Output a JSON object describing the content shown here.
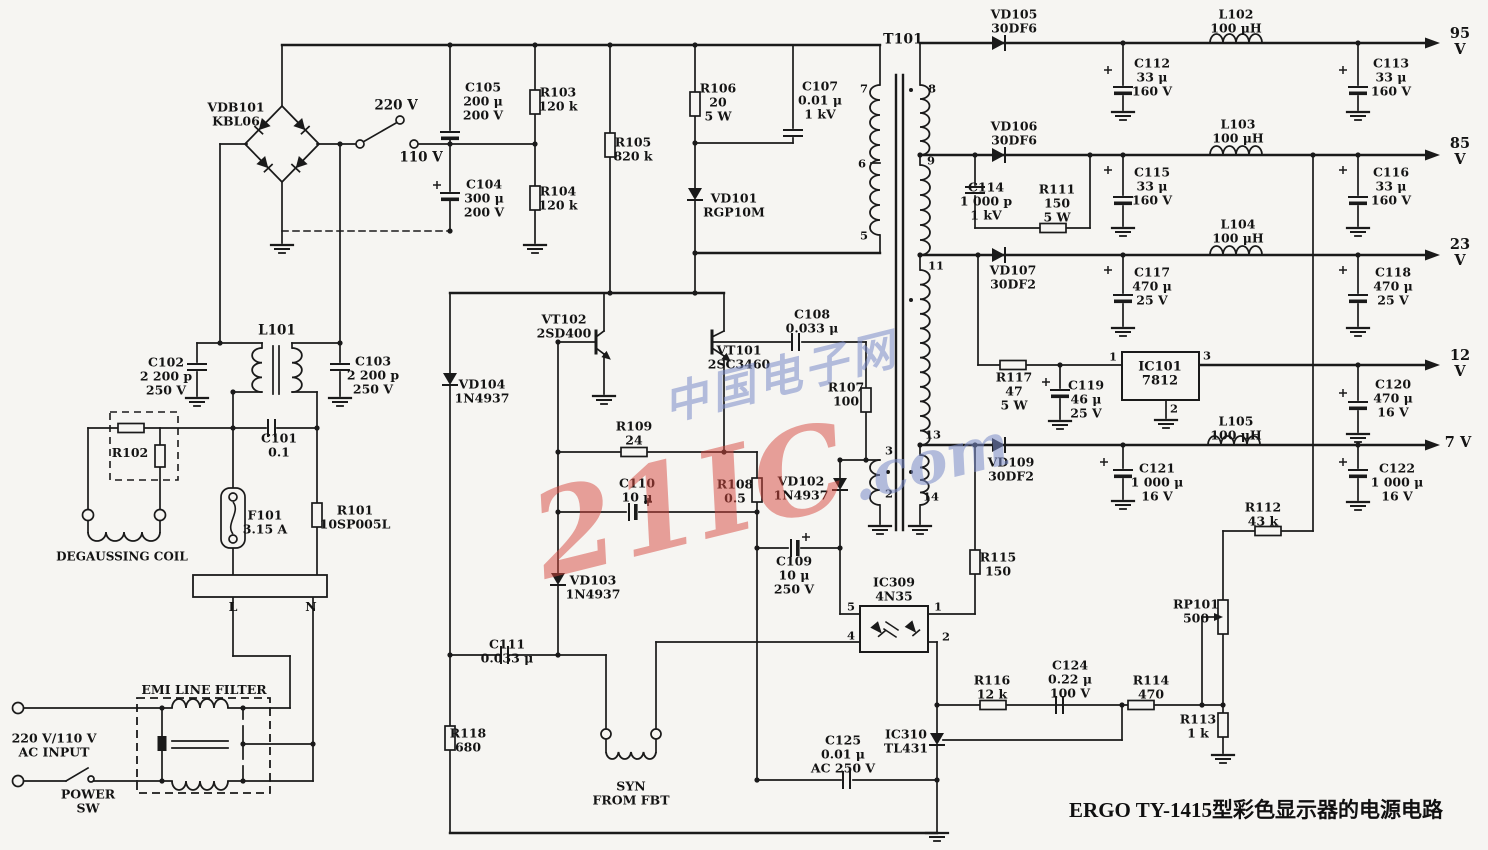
{
  "title": "ERGO TY-1415型彩色显示器的电源电路",
  "watermark": {
    "cn": "中国电子网",
    "brand": "21IC",
    "com": ".com"
  },
  "ink_color": "#1a1a1a",
  "labels": [
    {
      "id": "vdb101",
      "t": "VDB101\nKBL06",
      "x": 236,
      "y": 114
    },
    {
      "id": "v220",
      "t": "220 V",
      "x": 396,
      "y": 106,
      "fs": 13.5
    },
    {
      "id": "v110",
      "t": "110 V",
      "x": 421,
      "y": 158,
      "fs": 13.5
    },
    {
      "id": "c105",
      "t": "C105\n200 μ\n200 V",
      "x": 483,
      "y": 101
    },
    {
      "id": "r103",
      "t": "R103\n120 k",
      "x": 558,
      "y": 99
    },
    {
      "id": "c104",
      "t": "C104\n300 μ\n200 V",
      "x": 484,
      "y": 198
    },
    {
      "id": "r104",
      "t": "R104\n120 k",
      "x": 558,
      "y": 198
    },
    {
      "id": "r105",
      "t": "R105\n820 k",
      "x": 633,
      "y": 149
    },
    {
      "id": "r106",
      "t": "R106\n20\n5 W",
      "x": 718,
      "y": 102
    },
    {
      "id": "c107",
      "t": "C107\n0.01 μ\n1 kV",
      "x": 820,
      "y": 100
    },
    {
      "id": "vd101",
      "t": "VD101\nRGP10M",
      "x": 734,
      "y": 205
    },
    {
      "id": "t101",
      "t": "T101",
      "x": 903,
      "y": 40,
      "fs": 14
    },
    {
      "id": "vd105",
      "t": "VD105\n30DF6",
      "x": 1014,
      "y": 21
    },
    {
      "id": "c112",
      "t": "C112\n33 μ\n160 V",
      "x": 1152,
      "y": 77
    },
    {
      "id": "l102",
      "t": "L102\n100 μH",
      "x": 1236,
      "y": 21
    },
    {
      "id": "c113",
      "t": "C113\n33 μ\n160 V",
      "x": 1391,
      "y": 77
    },
    {
      "id": "v95",
      "t": "95 V",
      "x": 1460,
      "y": 42,
      "fs": 14.5
    },
    {
      "id": "vd106",
      "t": "VD106\n30DF6",
      "x": 1014,
      "y": 133
    },
    {
      "id": "c114",
      "t": "C114\n1 000 p\n1 kV",
      "x": 986,
      "y": 201
    },
    {
      "id": "r111",
      "t": "R111\n150\n5 W",
      "x": 1057,
      "y": 203
    },
    {
      "id": "c115",
      "t": "C115\n33 μ\n160 V",
      "x": 1152,
      "y": 186
    },
    {
      "id": "l103",
      "t": "L103\n100 μH",
      "x": 1238,
      "y": 131
    },
    {
      "id": "c116",
      "t": "C116\n33 μ\n160 V",
      "x": 1391,
      "y": 186
    },
    {
      "id": "v85",
      "t": "85 V",
      "x": 1460,
      "y": 152,
      "fs": 14.5
    },
    {
      "id": "vd107",
      "t": "VD107\n30DF2",
      "x": 1013,
      "y": 277
    },
    {
      "id": "c117",
      "t": "C117\n470 μ\n25 V",
      "x": 1152,
      "y": 286
    },
    {
      "id": "l104",
      "t": "L104\n100 μH",
      "x": 1238,
      "y": 231
    },
    {
      "id": "c118",
      "t": "C118\n470 μ\n25 V",
      "x": 1393,
      "y": 286
    },
    {
      "id": "v23",
      "t": "23 V",
      "x": 1460,
      "y": 253,
      "fs": 14.5
    },
    {
      "id": "r117",
      "t": "R117\n47\n5 W",
      "x": 1014,
      "y": 391
    },
    {
      "id": "c119",
      "t": "C119\n46 μ\n25 V",
      "x": 1086,
      "y": 399
    },
    {
      "id": "ic101",
      "t": "IC101\n7812",
      "x": 1160,
      "y": 375,
      "fs": 13
    },
    {
      "id": "c120",
      "t": "C120\n470 μ\n16 V",
      "x": 1393,
      "y": 398
    },
    {
      "id": "v12",
      "t": "12 V",
      "x": 1460,
      "y": 364,
      "fs": 14.5
    },
    {
      "id": "vd109",
      "t": "VD109\n30DF2",
      "x": 1011,
      "y": 469
    },
    {
      "id": "c121",
      "t": "C121\n1 000 μ\n16 V",
      "x": 1157,
      "y": 482
    },
    {
      "id": "l105",
      "t": "L105\n100 μH",
      "x": 1236,
      "y": 428
    },
    {
      "id": "c122",
      "t": "C122\n1 000 μ\n16 V",
      "x": 1397,
      "y": 482
    },
    {
      "id": "v7",
      "t": "7 V",
      "x": 1458,
      "y": 443,
      "fs": 14.5
    },
    {
      "id": "r112",
      "t": "R112\n43 k",
      "x": 1263,
      "y": 514
    },
    {
      "id": "rp101",
      "t": "RP101\n500",
      "x": 1196,
      "y": 611
    },
    {
      "id": "r113",
      "t": "R113\n1 k",
      "x": 1198,
      "y": 726
    },
    {
      "id": "r114",
      "t": "R114\n470",
      "x": 1151,
      "y": 687
    },
    {
      "id": "c124",
      "t": "C124\n0.22 μ\n100 V",
      "x": 1070,
      "y": 679
    },
    {
      "id": "r116",
      "t": "R116\n12 k",
      "x": 992,
      "y": 687
    },
    {
      "id": "ic310",
      "t": "IC310\nTL431",
      "x": 906,
      "y": 741
    },
    {
      "id": "c125",
      "t": "C125\n0.01 μ\nAC 250 V",
      "x": 843,
      "y": 754
    },
    {
      "id": "ic309",
      "t": "IC309\n4N35",
      "x": 894,
      "y": 589
    },
    {
      "id": "r115",
      "t": "R115\n150",
      "x": 998,
      "y": 564
    },
    {
      "id": "c109",
      "t": "C109\n10 μ\n250 V",
      "x": 794,
      "y": 575
    },
    {
      "id": "vd102",
      "t": "VD102\n1N4937",
      "x": 801,
      "y": 488
    },
    {
      "id": "r108",
      "t": "R108\n0.5",
      "x": 735,
      "y": 491
    },
    {
      "id": "r107",
      "t": "R107\n100",
      "x": 846,
      "y": 394
    },
    {
      "id": "c108",
      "t": "C108\n0.033 μ",
      "x": 812,
      "y": 321
    },
    {
      "id": "vt101",
      "t": "VT101\n2SC3460",
      "x": 739,
      "y": 357
    },
    {
      "id": "vt102",
      "t": "VT102\n2SD400",
      "x": 564,
      "y": 326
    },
    {
      "id": "vd104",
      "t": "VD104\n1N4937",
      "x": 482,
      "y": 391
    },
    {
      "id": "r109",
      "t": "R109\n24",
      "x": 634,
      "y": 433
    },
    {
      "id": "c110",
      "t": "C110\n10 μ",
      "x": 637,
      "y": 490
    },
    {
      "id": "vd103",
      "t": "VD103\n1N4937",
      "x": 593,
      "y": 587
    },
    {
      "id": "c111",
      "t": "C111\n0.033 μ",
      "x": 507,
      "y": 651
    },
    {
      "id": "r118",
      "t": "R118\n680",
      "x": 468,
      "y": 740
    },
    {
      "id": "syn",
      "t": "SYN\nFROM FBT",
      "x": 631,
      "y": 793
    },
    {
      "id": "l101",
      "t": "L101",
      "x": 277,
      "y": 331,
      "fs": 13.5
    },
    {
      "id": "c102",
      "t": "C102\n2 200 p\n250 V",
      "x": 166,
      "y": 376
    },
    {
      "id": "c103",
      "t": "C103\n2 200 p\n250 V",
      "x": 373,
      "y": 375
    },
    {
      "id": "c101",
      "t": "C101\n0.1",
      "x": 279,
      "y": 445
    },
    {
      "id": "r102",
      "t": "R102",
      "x": 130,
      "y": 453
    },
    {
      "id": "f101",
      "t": "F101\n3.15 A",
      "x": 265,
      "y": 522
    },
    {
      "id": "r101",
      "t": "R101\n10SP005L",
      "x": 355,
      "y": 517
    },
    {
      "id": "degaussing",
      "t": "DEGAUSSING  COIL",
      "x": 122,
      "y": 557,
      "fs": 12
    },
    {
      "id": "lab-l",
      "t": "L",
      "x": 233,
      "y": 607,
      "fs": 12.5
    },
    {
      "id": "lab-n",
      "t": "N",
      "x": 311,
      "y": 607,
      "fs": 12.5
    },
    {
      "id": "emi",
      "t": "EMI  LINE  FILTER",
      "x": 204,
      "y": 690,
      "fs": 12.5
    },
    {
      "id": "ac-input",
      "t": "220 V/110 V\nAC INPUT",
      "x": 54,
      "y": 745
    },
    {
      "id": "power-sw",
      "t": "POWER\nSW",
      "x": 88,
      "y": 801
    },
    {
      "id": "pin-7",
      "t": "7",
      "x": 864,
      "y": 89,
      "fs": 11.5
    },
    {
      "id": "pin-6",
      "t": "6",
      "x": 862,
      "y": 164,
      "fs": 11.5
    },
    {
      "id": "pin-5",
      "t": "5",
      "x": 864,
      "y": 236,
      "fs": 11.5
    },
    {
      "id": "pin-8",
      "t": "8",
      "x": 932,
      "y": 89,
      "fs": 11.5
    },
    {
      "id": "pin-9",
      "t": "9",
      "x": 931,
      "y": 161,
      "fs": 11.5
    },
    {
      "id": "pin-11",
      "t": "11",
      "x": 936,
      "y": 266,
      "fs": 11.5
    },
    {
      "id": "pin-13",
      "t": "13",
      "x": 933,
      "y": 435,
      "fs": 11.5
    },
    {
      "id": "pin-14",
      "t": "14",
      "x": 931,
      "y": 497,
      "fs": 11.5
    },
    {
      "id": "pin-3",
      "t": "3",
      "x": 889,
      "y": 451,
      "fs": 11.5
    },
    {
      "id": "pin-2",
      "t": "2",
      "x": 889,
      "y": 494,
      "fs": 11.5
    },
    {
      "id": "ic101-pin1",
      "t": "1",
      "x": 1113,
      "y": 357,
      "fs": 11.5
    },
    {
      "id": "ic101-pin3",
      "t": "3",
      "x": 1207,
      "y": 356,
      "fs": 11.5
    },
    {
      "id": "ic101-pin2",
      "t": "2",
      "x": 1174,
      "y": 409,
      "fs": 11.5
    },
    {
      "id": "ic309-pin5",
      "t": "5",
      "x": 851,
      "y": 607,
      "fs": 11.5
    },
    {
      "id": "ic309-pin4",
      "t": "4",
      "x": 851,
      "y": 636,
      "fs": 11.5
    },
    {
      "id": "ic309-pin1",
      "t": "1",
      "x": 938,
      "y": 607,
      "fs": 11.5
    },
    {
      "id": "ic309-pin2",
      "t": "2",
      "x": 946,
      "y": 637,
      "fs": 11.5
    }
  ]
}
